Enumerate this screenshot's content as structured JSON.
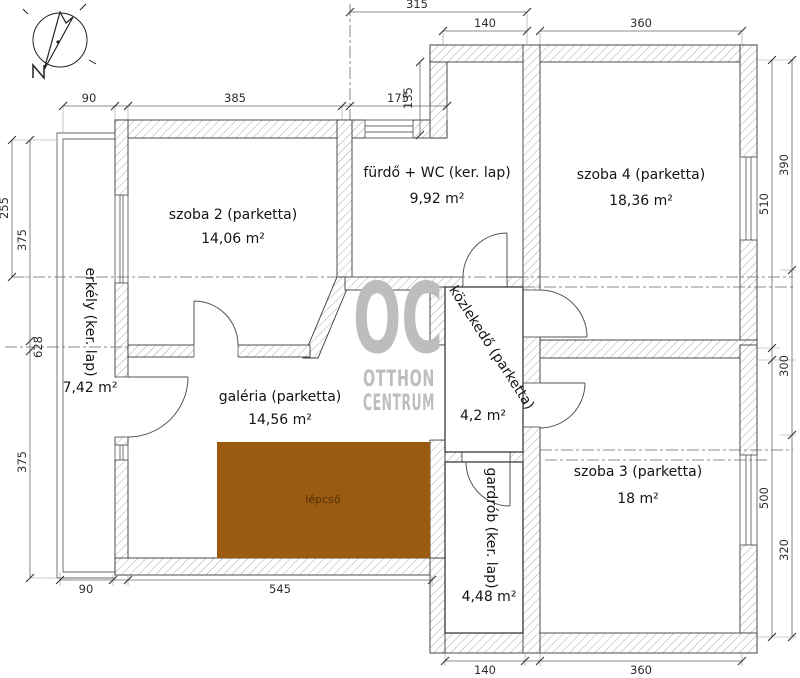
{
  "north": {
    "label": "N"
  },
  "watermark": {
    "line1": "OC",
    "line2": "OTTHON",
    "line3": "CENTRUM"
  },
  "rooms": {
    "szoba2": {
      "name": "szoba 2 (parketta)",
      "area": "14,06 m²"
    },
    "furdo": {
      "name": "fürdő + WC (ker. lap)",
      "area": "9,92 m²"
    },
    "szoba4": {
      "name": "szoba 4 (parketta)",
      "area": "18,36 m²"
    },
    "erkely": {
      "name": "erkély (ker. lap)",
      "area": "7,42 m²"
    },
    "galeria": {
      "name": "galéria (parketta)",
      "area": "14,56 m²"
    },
    "kozlekedo": {
      "name": "közlekedő (parketta)",
      "area": "4,2 m²"
    },
    "szoba3": {
      "name": "szoba 3 (parketta)",
      "area": "18 m²"
    },
    "gardrob": {
      "name": "gardrób (ker. lap)",
      "area": "4,48 m²"
    },
    "lepcso": {
      "name": "lépcső"
    }
  },
  "dimensions": {
    "top": [
      "315",
      "140",
      "360"
    ],
    "upper": [
      "90",
      "385",
      "175",
      "135"
    ],
    "left": [
      "255",
      "375",
      "628",
      "375"
    ],
    "bottom": [
      "90",
      "545",
      "140",
      "360"
    ],
    "right_outer": [
      "390",
      "300",
      "320"
    ],
    "right_inner": [
      "510",
      "500"
    ]
  },
  "colors": {
    "stairs": "#9a5a10",
    "stairs_text": "#50300a",
    "watermark": "#bdbdbd"
  }
}
